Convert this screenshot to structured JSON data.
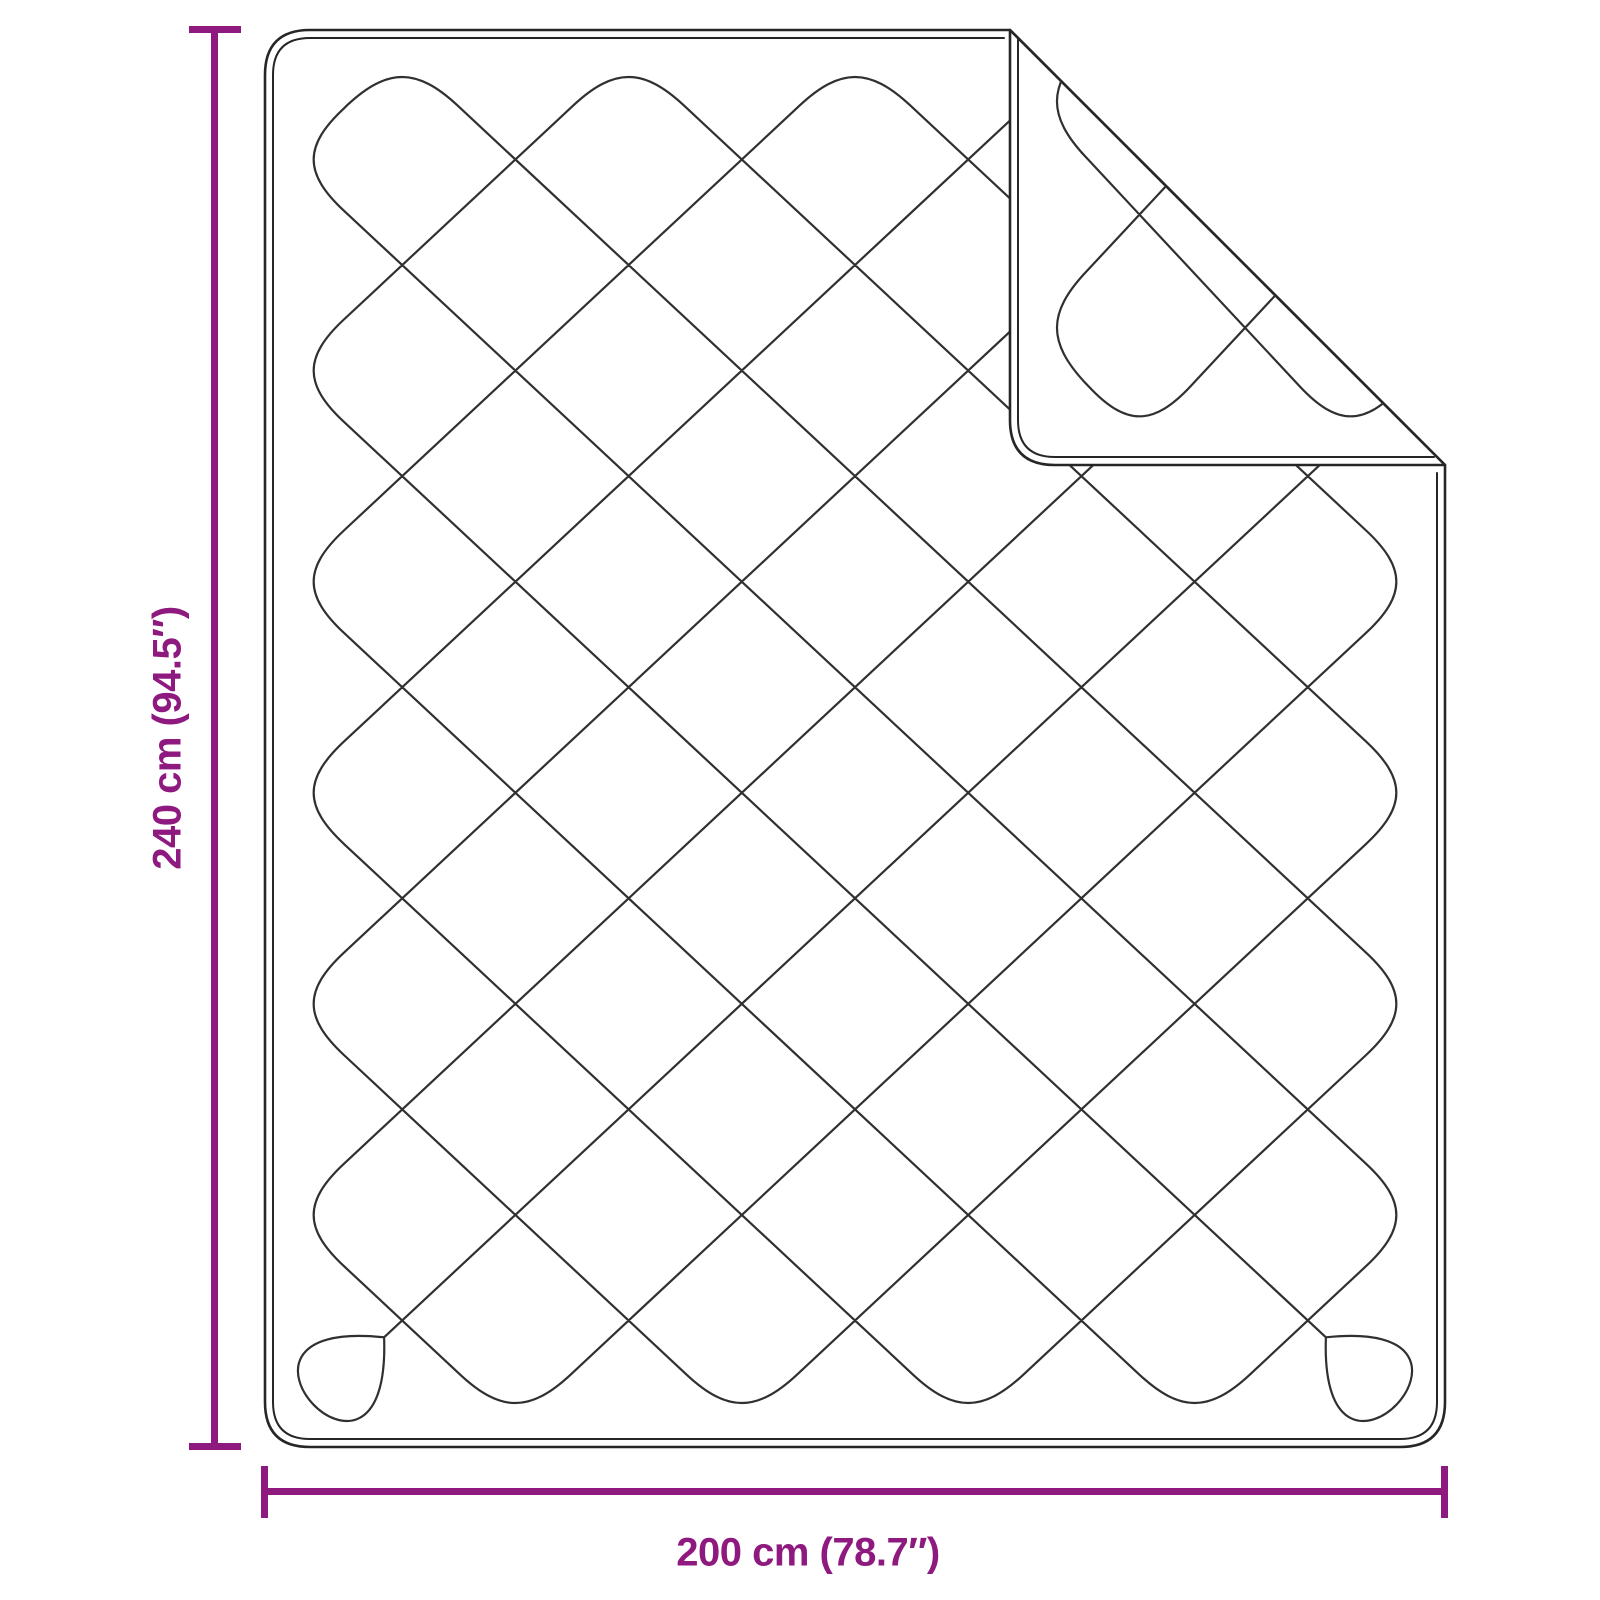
{
  "diagram": {
    "type": "product dimension drawing",
    "subject": "quilted blanket with folded-over corner",
    "annotations": {
      "height_label": "240 cm (94.5″)",
      "width_label": "200 cm (78.7″)",
      "height_cm": 240,
      "height_in": 94.5,
      "width_cm": 200,
      "width_in": 78.7
    },
    "colors": {
      "dimension_accent": "#8e1a80",
      "outline": "#262626",
      "pattern_line": "#303030",
      "background": "#ffffff"
    }
  }
}
